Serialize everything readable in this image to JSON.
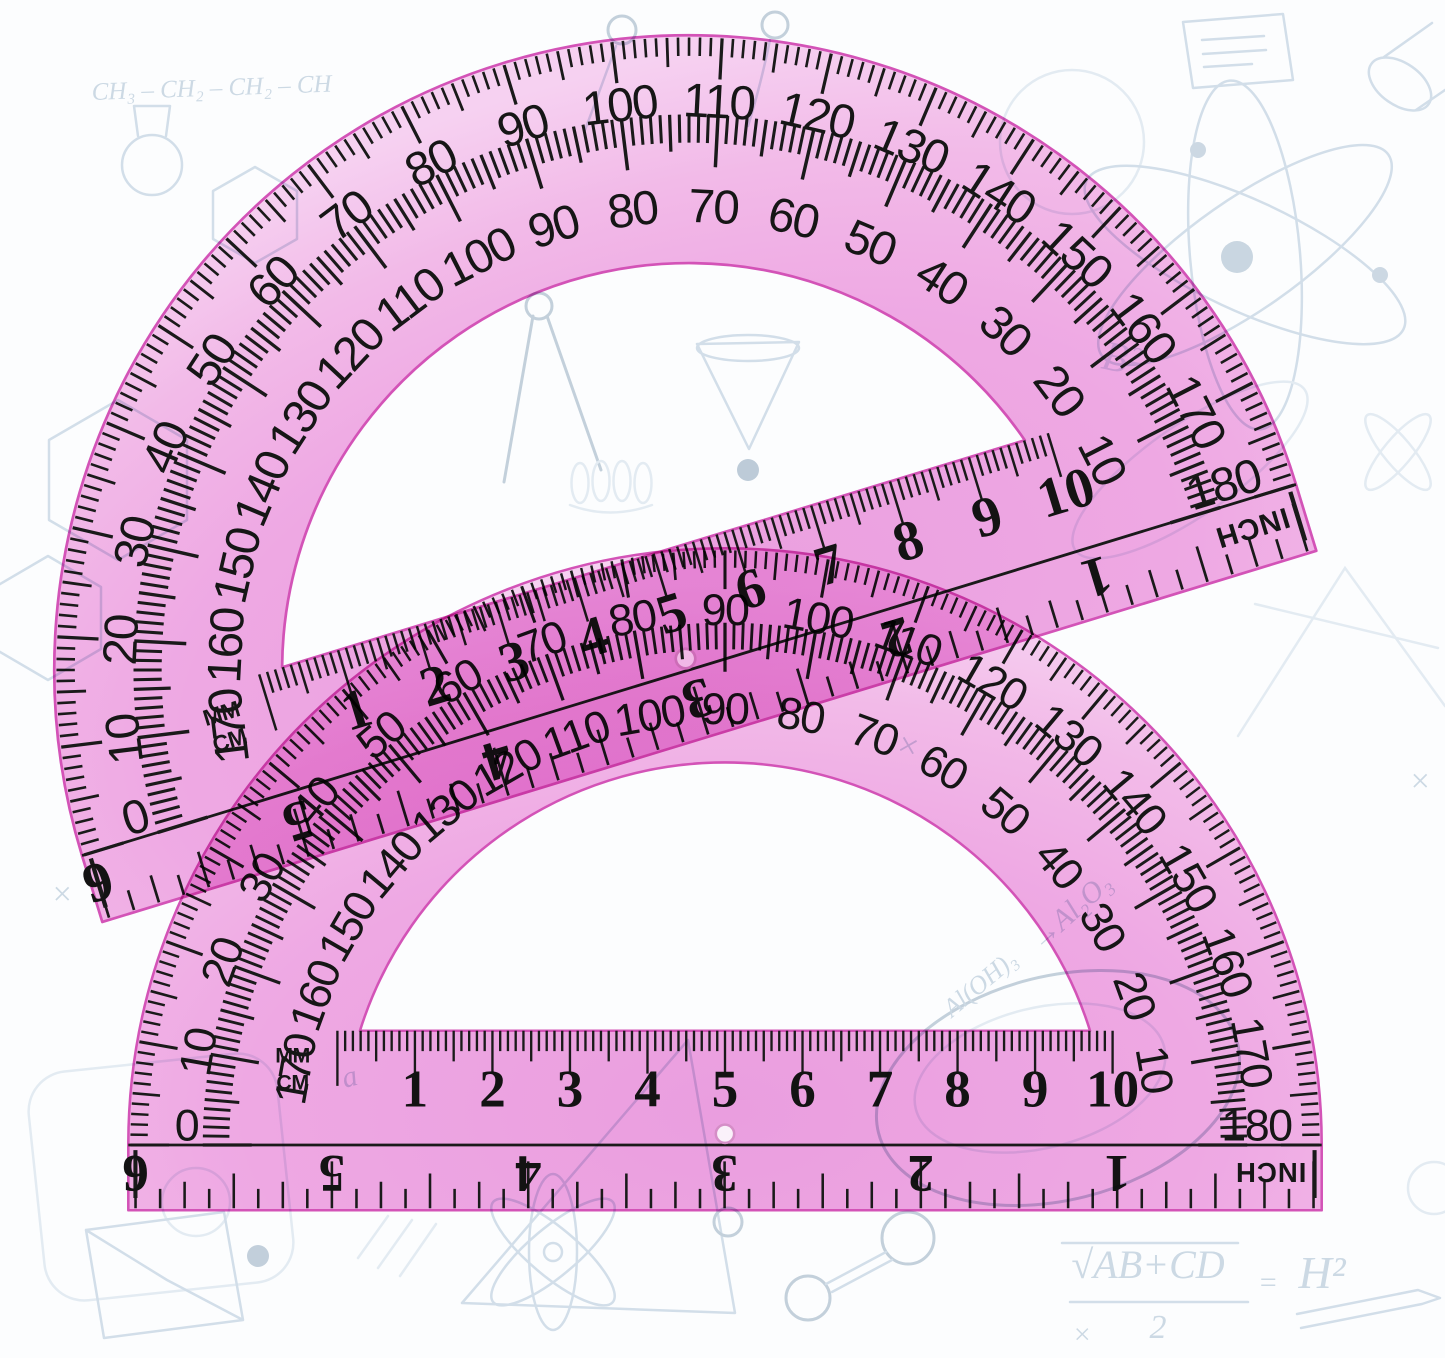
{
  "scene": {
    "description": "Two translucent pink semicircular protractors with ruler edges overlapping on a white background with faint science doodles",
    "width": 1445,
    "height": 1358
  },
  "colors": {
    "background": "#fcfdfe",
    "pink_deep": "#ed9fe0",
    "pink_mid": "#f1a9e4",
    "pink_light": "#f5bce9",
    "pink_pale": "#f9d3f2",
    "edge": "#d653b8",
    "ink": "#1a1a1a",
    "hole_stroke": "#d88fc8",
    "doodle": "#d2dee9",
    "doodle_dark": "#c3d0db"
  },
  "protractors": {
    "geometry": {
      "outer_radius": 585,
      "band_h": 64,
      "strip_h": 112,
      "cut_r": 375,
      "rim_tick": [
        17,
        27,
        38
      ],
      "mid_r": 512,
      "mid_tick": [
        26,
        34,
        48
      ],
      "outer_num_r": 525,
      "inner_num_r": 428,
      "cm_half": 380,
      "cm_step": 76,
      "inch_step": 24.06,
      "inch_num_step": 192.5
    },
    "scales": {
      "outer": [
        10,
        20,
        30,
        40,
        50,
        60,
        70,
        80,
        90,
        100,
        110,
        120,
        130,
        140,
        150,
        160,
        170
      ],
      "inner": [
        170,
        160,
        150,
        140,
        130,
        120,
        110,
        100,
        90,
        80,
        70,
        60,
        50,
        40,
        30,
        20,
        10
      ],
      "baseline_left": "0",
      "baseline_right": "180",
      "cm": [
        1,
        2,
        3,
        4,
        5,
        6,
        7,
        8,
        9,
        10
      ],
      "unit_mm": "MM",
      "unit_cm": "CM",
      "inch": [
        1,
        2,
        3,
        4,
        5,
        6
      ],
      "inch_unit": "INCH"
    },
    "instances": [
      {
        "name": "protractor-top",
        "cx": 689,
        "cy": 670,
        "rotation": -17,
        "scale": 1.085
      },
      {
        "name": "protractor-bottom",
        "cx": 725,
        "cy": 1145,
        "rotation": 0,
        "scale": 1.02
      }
    ]
  },
  "doodles": {
    "texts": [
      {
        "text": "CH₃ – CH₂ – CH₂ – CH"
      },
      {
        "text": "B²"
      },
      {
        "text": "→Al₂O₃"
      },
      {
        "text": "Al(OH)₃"
      },
      {
        "text": "√AB+CD"
      },
      {
        "text": "2"
      },
      {
        "text": "="
      },
      {
        "text": "H²"
      },
      {
        "text": "×"
      },
      {
        "text": "×"
      },
      {
        "text": "×"
      },
      {
        "text": "×"
      },
      {
        "text": "a"
      }
    ]
  }
}
